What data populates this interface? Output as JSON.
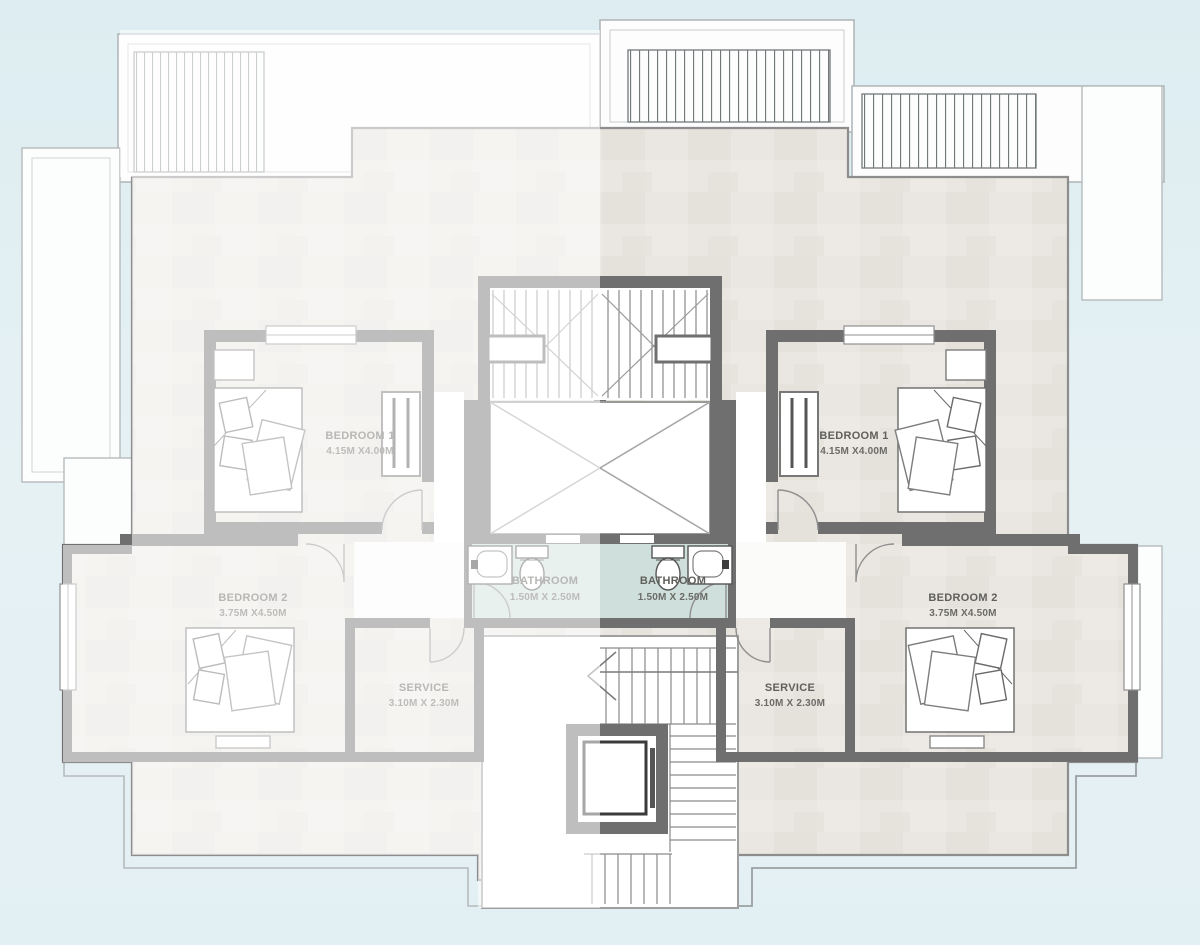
{
  "plan": {
    "type": "residential-floor-plan",
    "rooms": {
      "left": {
        "bedroom1": {
          "name": "BEDROOM 1",
          "dims": "4.15M X4.00M"
        },
        "bedroom2": {
          "name": "BEDROOM 2",
          "dims": "3.75M X4.50M"
        },
        "bathroom": {
          "name": "BATHROOM",
          "dims": "1.50M X 2.50M"
        },
        "service": {
          "name": "SERVICE",
          "dims": "3.10M X 2.30M"
        }
      },
      "right": {
        "bedroom1": {
          "name": "BEDROOM 1",
          "dims": "4.15M X4.00M"
        },
        "bedroom2": {
          "name": "BEDROOM 2",
          "dims": "3.75M X4.50M"
        },
        "bathroom": {
          "name": "BATHROOM",
          "dims": "1.50M X 2.50M"
        },
        "service": {
          "name": "SERVICE",
          "dims": "3.10M X 2.30M"
        }
      }
    },
    "colors": {
      "background_blue": "#e2eff2",
      "floor_tile": "#eae6e1",
      "wall_dark": "#6f6f6f",
      "wall_faded": "#c2c4c4",
      "bathroom_floor": "#cfdfdb",
      "outline_light": "#b3b9bb",
      "label_text": "#5f5f5c"
    },
    "icons": [
      "stairs-icon",
      "elevator-icon",
      "double-bed-icon",
      "toilet-icon",
      "sink-icon",
      "door-arc-icon",
      "pergola-slats-icon",
      "shaft-x-icon",
      "direction-arrow-icon"
    ]
  }
}
